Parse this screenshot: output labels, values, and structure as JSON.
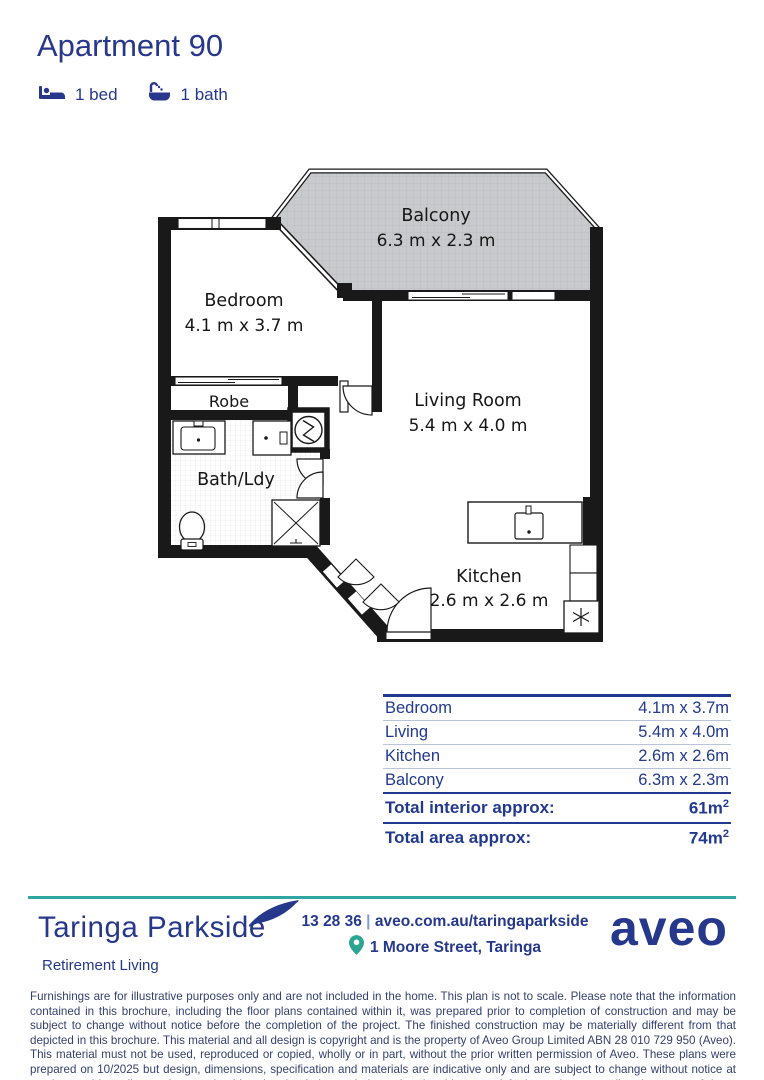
{
  "colors": {
    "navy": "#27378c",
    "teal": "#2fa69f",
    "plan_line": "#191919",
    "balcony_fill": "#c9cacd"
  },
  "header": {
    "title": "Apartment 90",
    "bed": {
      "icon": "bed-icon",
      "label": "1 bed"
    },
    "bath": {
      "icon": "bath-icon",
      "label": "1 bath"
    }
  },
  "floorplan": {
    "balcony": {
      "name": "Balcony",
      "dims": "6.3 m x 2.3 m"
    },
    "bedroom": {
      "name": "Bedroom",
      "dims": "4.1 m x 3.7 m"
    },
    "robe": {
      "name": "Robe"
    },
    "bath": {
      "name": "Bath/Ldy"
    },
    "living": {
      "name": "Living Room",
      "dims": "5.4 m x 4.0 m"
    },
    "kitchen": {
      "name": "Kitchen",
      "dims": "2.6 m x 2.6 m"
    }
  },
  "summary_table": {
    "rows": [
      {
        "label": "Bedroom",
        "value": "4.1m x 3.7m"
      },
      {
        "label": "Living",
        "value": "5.4m x 4.0m"
      },
      {
        "label": "Kitchen",
        "value": "2.6m x 2.6m"
      },
      {
        "label": "Balcony",
        "value": "6.3m x 2.3m"
      }
    ],
    "totals": [
      {
        "label": "Total interior approx:",
        "value": "61m",
        "sup": "2"
      },
      {
        "label": "Total area approx:",
        "value": "74m",
        "sup": "2"
      }
    ]
  },
  "footer": {
    "brand": "Taringa Parkside",
    "tagline": "Retirement Living",
    "phone": "13 28 36",
    "separator": "|",
    "website": "aveo.com.au/taringaparkside",
    "address": "1 Moore Street, Taringa",
    "logo_text": "aveo"
  },
  "disclaimer": "Furnishings are for illustrative purposes only and are not included in the home. This plan is not to scale. Please note that the information contained in this brochure, including the floor plans contained within it, was prepared prior to completion of construction and may be subject to change without notice before the completion of the project. The finished construction may be materially different from that depicted in this brochure. This material and all design is copyright and is the property of Aveo Group Limited ABN 28 010 729 950 (Aveo). This material must not be used, reproduced or copied, wholly or in part, without the prior written permission of Aveo. These plans were prepared on 10/2025 but design, dimensions, specification and materials are indicative only and are subject to change without notice at anytime and intending puchasers should undertake their own independent inquiries to satisfy themselves regarding the status of these plans. You should refer to appropriate Survey Plans for confirmation of individual unit areas."
}
